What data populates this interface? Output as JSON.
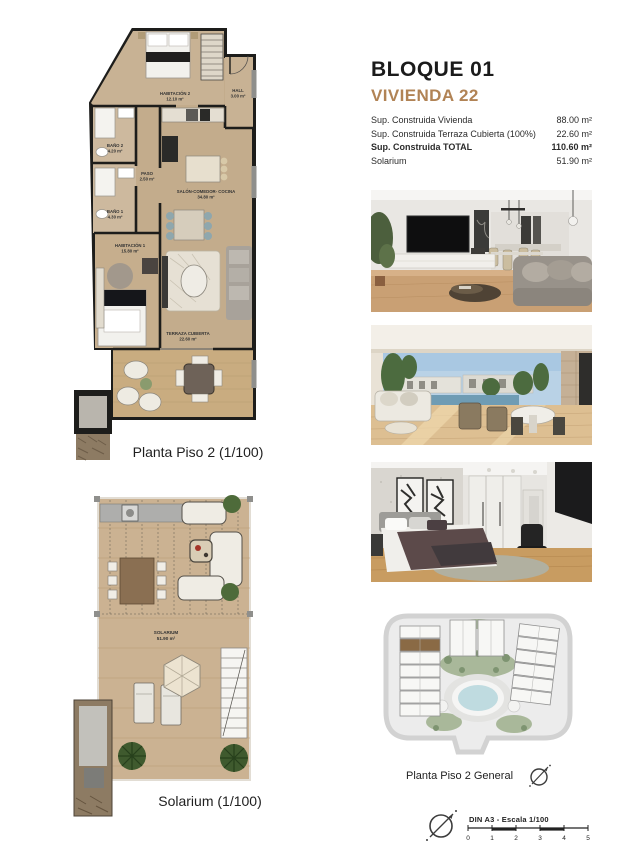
{
  "header": {
    "bloque": "BLOQUE 01",
    "vivienda": "VIVIENDA 22"
  },
  "colors": {
    "accent": "#b18355",
    "highlight_unit": "#8a6a45",
    "pool": "#bfdbe0",
    "plan_floor": "#c3ac8c"
  },
  "surface_table": {
    "rows": [
      {
        "label": "Sup. Construida Vivienda",
        "value": "88.00 m²"
      },
      {
        "label": "Sup. Construida Terraza Cubierta (100%)",
        "value": "22.60 m²"
      },
      {
        "label": "Sup. Construida TOTAL",
        "value": "110.60 m²"
      },
      {
        "label": "Solarium",
        "value": "51.90 m²"
      }
    ]
  },
  "plans": {
    "piso2": {
      "caption": "Planta Piso 2 (1/100)",
      "rooms": {
        "habitacion2": {
          "name": "HABITACIÓN 2",
          "area": "12.10 m²"
        },
        "hall": {
          "name": "HALL",
          "area": "3.00 m²"
        },
        "bano2": {
          "name": "BAÑO 2",
          "area": "4.20 m²"
        },
        "paso": {
          "name": "PASO",
          "area": "2.50 m²"
        },
        "bano1": {
          "name": "BAÑO 1",
          "area": "4.30 m²"
        },
        "salon": {
          "name": "SALÓN-COMEDOR- COCINA",
          "area": "34.80 m²"
        },
        "habitacion1": {
          "name": "HABITACIÓN 1",
          "area": "15.80 m²"
        },
        "terraza": {
          "name": "TERRAZA CUBIERTA",
          "area": "22.60 m²"
        }
      }
    },
    "solarium": {
      "caption": "Solarium (1/100)",
      "room": {
        "name": "SOLARIUM",
        "area": "51.90 m²"
      }
    },
    "general": {
      "caption": "Planta Piso 2 General"
    }
  },
  "scale_bar": {
    "title": "DIN A3 - Escala 1/100",
    "ticks": [
      "0",
      "1",
      "2",
      "3",
      "4",
      "5"
    ]
  }
}
